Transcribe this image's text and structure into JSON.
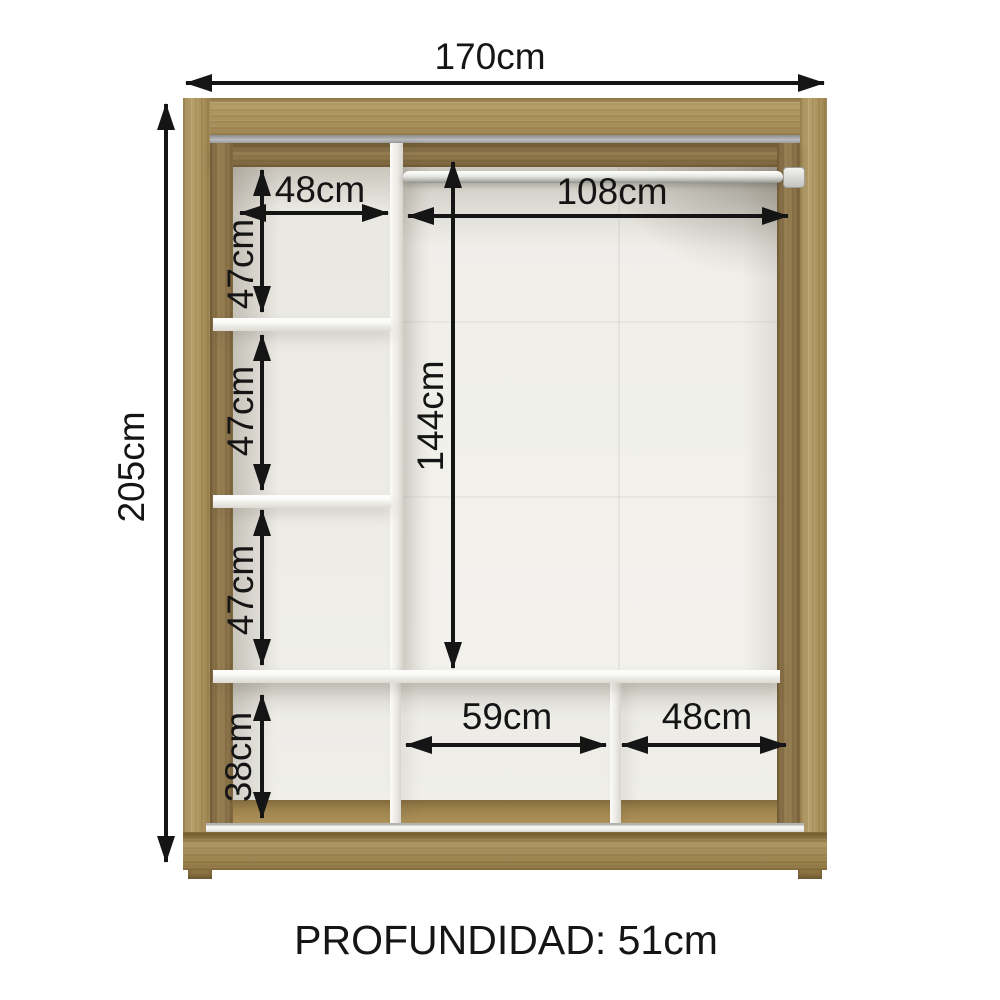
{
  "dims": {
    "total_width": "170cm",
    "total_height": "205cm",
    "left_column_width": "48cm",
    "left_shelf_gap_1": "47cm",
    "left_shelf_gap_2": "47cm",
    "left_shelf_gap_3": "47cm",
    "bottom_left_height": "38cm",
    "rod_width": "108cm",
    "main_height": "144cm",
    "bottom_middle_width": "59cm",
    "bottom_right_width": "48cm",
    "depth": "PROFUNDIDAD: 51cm"
  },
  "measurements_cm": {
    "width": 170,
    "height": 205,
    "depth": 51,
    "left_column_width": 48,
    "left_shelf_gap": 47,
    "bottom_left_height": 38,
    "rod_section_width": 108,
    "main_section_height": 144,
    "bottom_middle_width": 59,
    "bottom_right_width": 48
  },
  "colors": {
    "wood": "#b1975f",
    "wood_dark": "#8e7444",
    "interior": "#efeee9",
    "annotation": "#151515",
    "background": "#ffffff"
  }
}
